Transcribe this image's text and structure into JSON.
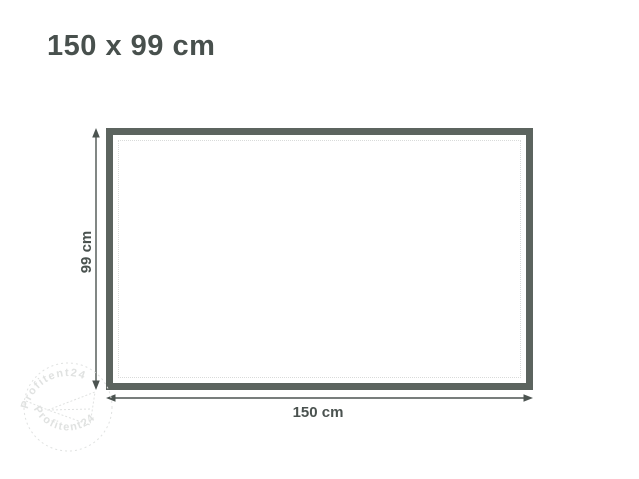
{
  "header": {
    "title": "150 x 99 cm"
  },
  "diagram": {
    "width_label": "150 cm",
    "height_label": "99 cm"
  },
  "watermark": {
    "arc_text_top": "Profitent24",
    "arc_text_bottom": "Profitent24"
  },
  "colors": {
    "background": "#ffffff",
    "title": "#48504d",
    "rect_border": "#5c645f",
    "rect_fill": "#ffffff",
    "seam_dotted": "#d9dbda",
    "dimension": "#4c5451",
    "label": "#4a524f",
    "watermark": "#e0e2e1"
  }
}
